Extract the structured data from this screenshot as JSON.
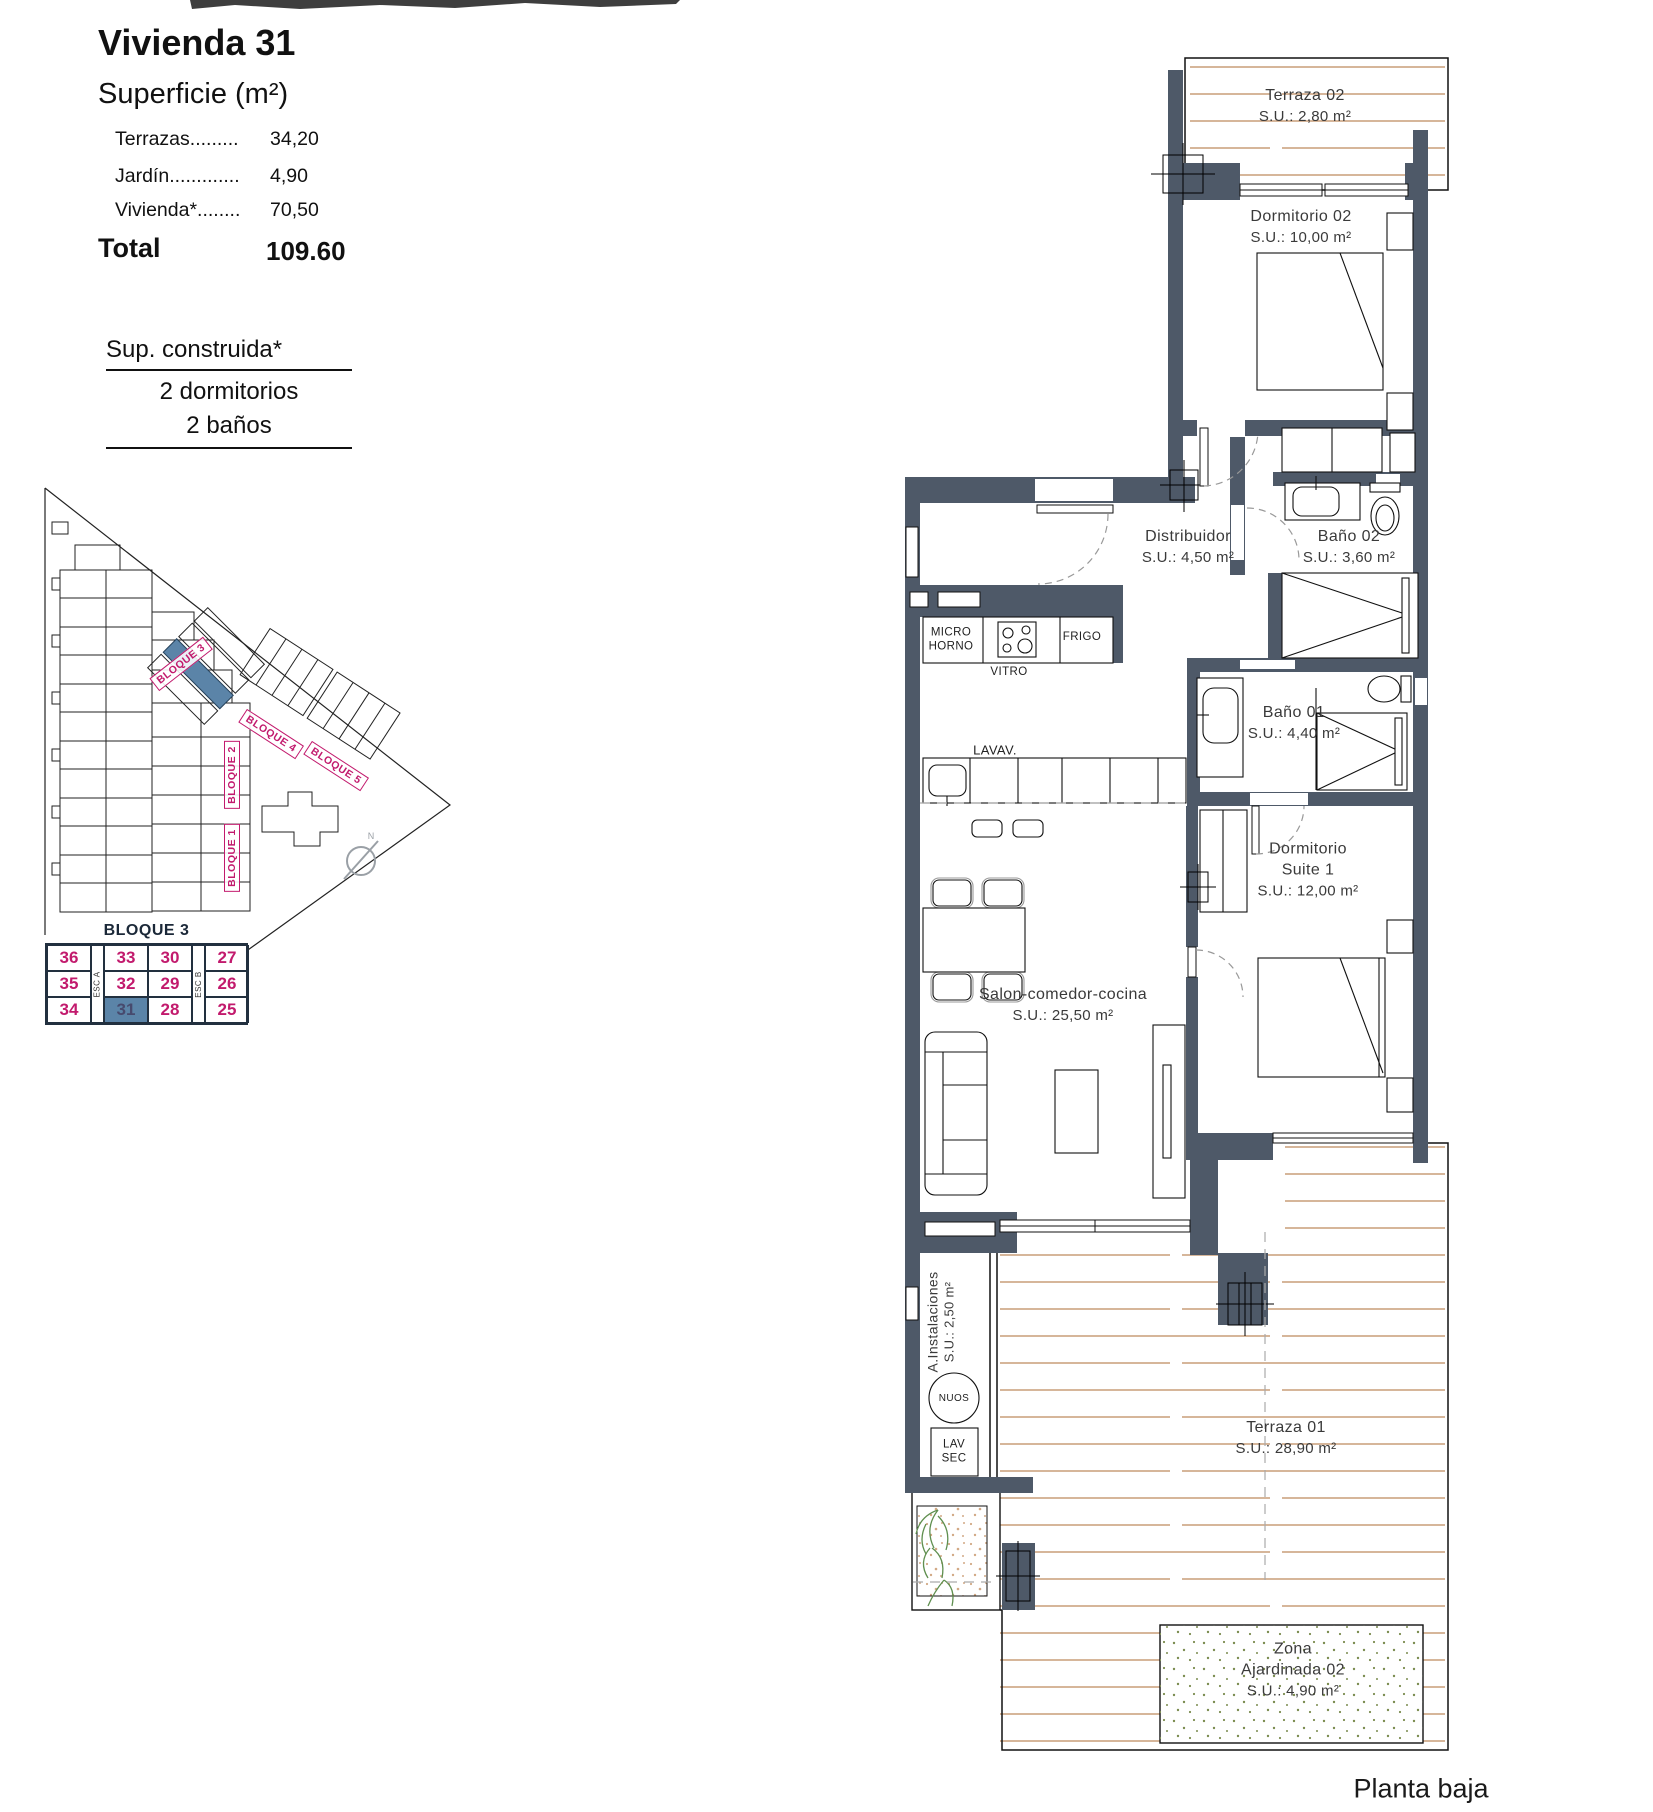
{
  "info_panel": {
    "title": "Vivienda 31",
    "subtitle": "Superficie (m²)",
    "rows": [
      {
        "label": "Terrazas.........",
        "value": "34,20"
      },
      {
        "label": "Jardín.............",
        "value": "4,90"
      },
      {
        "label": "Vivienda*........",
        "value": "70,50"
      }
    ],
    "total_label": "Total",
    "total_value": "109.60",
    "built_heading": "Sup. construida*",
    "bedrooms": "2 dormitorios",
    "bathrooms": "2 baños"
  },
  "site_plan": {
    "labels": {
      "bloque1": "BLOQUE 1",
      "bloque2": "BLOQUE 2",
      "bloque3": "BLOQUE 3",
      "bloque4": "BLOQUE 4",
      "bloque5": "BLOQUE 5"
    },
    "compass": "N",
    "highlighted_block": "BLOQUE 3"
  },
  "key_table": {
    "title": "BLOQUE 3",
    "stair_a": "ESC A",
    "stair_b": "ESC B",
    "rows": [
      [
        "36",
        "33",
        "30",
        "27"
      ],
      [
        "35",
        "32",
        "29",
        "26"
      ],
      [
        "34",
        "31",
        "28",
        "25"
      ]
    ],
    "highlighted_unit": "31"
  },
  "floor_plan": {
    "rooms": {
      "terraza02": {
        "name": "Terraza 02",
        "area": "S.U.: 2,80 m²"
      },
      "dormitorio02": {
        "name": "Dormitorio 02",
        "area": "S.U.: 10,00 m²"
      },
      "distribuidor": {
        "name": "Distribuidor",
        "area": "S.U.: 4,50 m²"
      },
      "bano02": {
        "name": "Baño 02",
        "area": "S.U.: 3,60 m²"
      },
      "bano01": {
        "name": "Baño 01",
        "area": "S.U.: 4,40 m²"
      },
      "suite": {
        "line1": "Dormitorio",
        "line2": "Suite 1",
        "area": "S.U.: 12,00 m²"
      },
      "salon": {
        "name": "Salon-comedor-cocina",
        "area": "S.U.: 25,50 m²"
      },
      "instalaciones": {
        "name": "A.Instalaciones",
        "area": "S.U.: 2,50 m²"
      },
      "terraza01": {
        "name": "Terraza 01",
        "area": "S.U.: 28,90 m²"
      },
      "jardin": {
        "line1": "Zona",
        "line2": "Ajardinada 02",
        "area": "S.U.: 4,90 m²"
      }
    },
    "fixtures": {
      "micro_1": "MICRO",
      "micro_2": "HORNO",
      "vitro": "VITRO",
      "frigo": "FRIGO",
      "lavavajillas": "LAVAV.",
      "nuos": "NUOS",
      "lav_1": "LAV",
      "lav_2": "SEC"
    },
    "footer": "Planta baja"
  },
  "colors": {
    "wall": "#4e5968",
    "deck": "#c99d78",
    "accent": "#c21a6d",
    "unit_highlight": "#5b84a8",
    "garden": "#7b8c4f"
  }
}
